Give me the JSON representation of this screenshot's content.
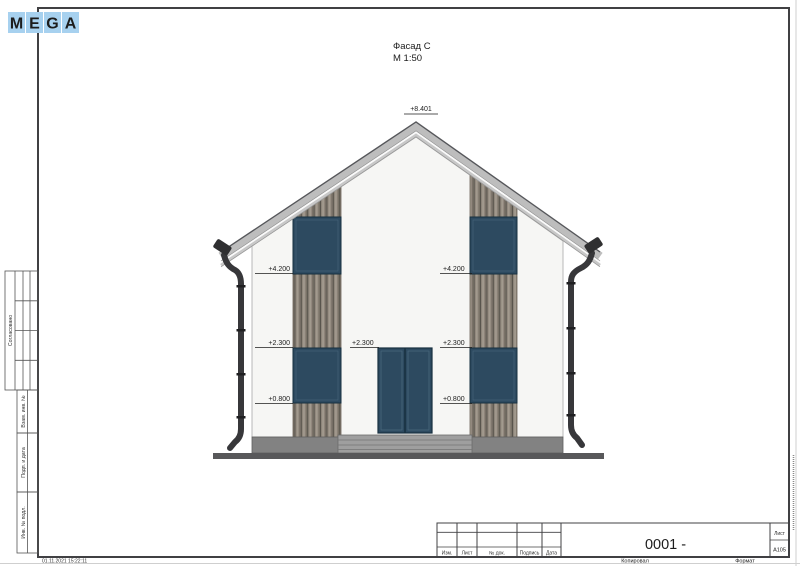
{
  "logo": {
    "letters": [
      "M",
      "E",
      "G",
      "A"
    ]
  },
  "drawing_title": {
    "name": "Фасад С",
    "scale": "М 1:50"
  },
  "elevations": {
    "peak": "+8.401",
    "left": [
      "+4.200",
      "+2.300",
      "+0.800"
    ],
    "door": "+2.300",
    "right": [
      "+4.200",
      "+2.300",
      "+0.800"
    ]
  },
  "sidebar": {
    "approved": "Согласовано",
    "replace_inv": "Взам. инв. №",
    "sign_date": "Подп. и дата",
    "inv_original": "Инв. № подл."
  },
  "title_block": {
    "columns": [
      "Изм.",
      "Лист",
      "№ док.",
      "Подпись",
      "Дата"
    ],
    "doc_number": "0001 -",
    "sheet_label": "Лист",
    "sheet_value": "А105"
  },
  "footer": {
    "timestamp": "01.11.2021 15:22:11",
    "copied": "Копировал",
    "format": "Формат"
  },
  "colors": {
    "logo_blue": "#a7d1ef",
    "window_glass": "#2d4a60",
    "wood_siding": "#8d8479",
    "roof_grey": "#bdbdbd"
  }
}
